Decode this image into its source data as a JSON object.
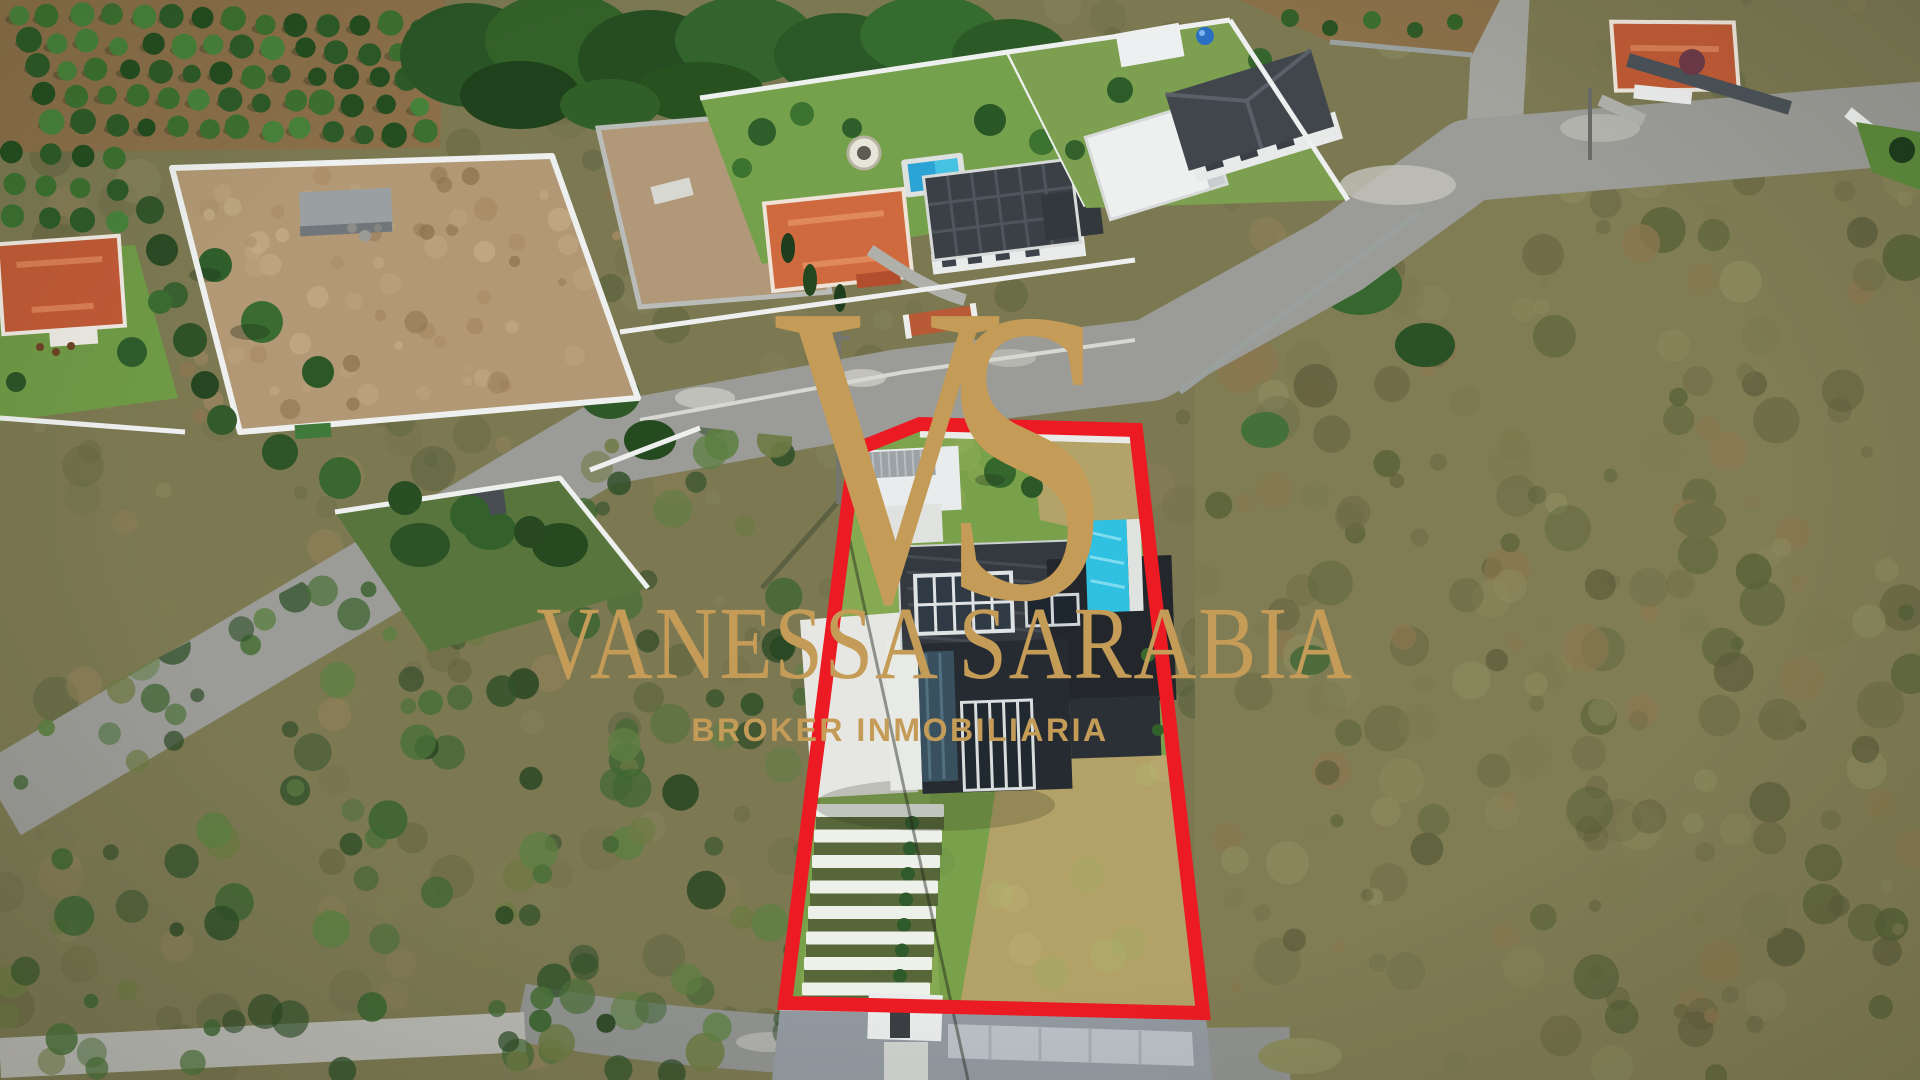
{
  "watermark": {
    "monogram_letters": {
      "v": "V",
      "s": "S"
    },
    "title": "VANESSA SARABIA",
    "subtitle": "BROKER INMOBILIARIA",
    "brand_gold": "#C49B57"
  },
  "highlight": {
    "outline_color": "#EC1B23"
  }
}
